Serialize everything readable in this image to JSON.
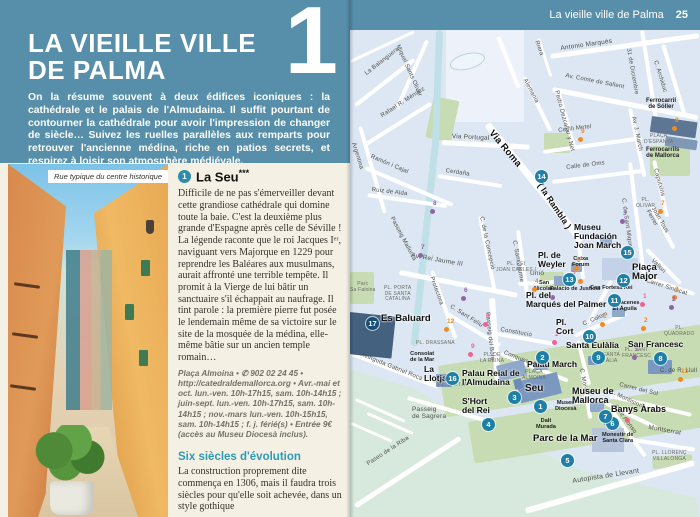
{
  "colors": {
    "header_blue": "#578fab",
    "accent_teal": "#2e9ab8",
    "poi_circle": "#1f7fa6",
    "orange": "#ef8b1f",
    "purple": "#9263a8",
    "pink": "#ee6392"
  },
  "left_page": {
    "chapter_number": "1",
    "title_line1": "LA VIEILLE VILLE",
    "title_line2": "DE PALMA",
    "intro": "On la résume souvent à deux édifices iconiques : la cathédrale et le palais de l'Almudaina. Il suffit pourtant de contourner la cathédrale pour avoir l'impression de changer de siècle… Suivez les ruelles parallèles aux remparts pour retrouver l'ancienne médina, riche en patios secrets, et respirez à loisir son atmosphère médiévale.",
    "photo_caption": "Rue typique du centre historique",
    "section1": {
      "marker": "1",
      "title": "La Seu",
      "stars": "***",
      "body": "Difficile de ne pas s'émerveiller devant cette grandiose cathédrale qui domine toute la baie. C'est la deuxième plus grande d'Espagne après celle de Séville ! La légende raconte que le roi Jacques Iᵉʳ, naviguant vers Majorque en 1229 pour reprendre les Baléares aux musulmans, aurait affronté une terrible tempête. Il promit à la Vierge de lui bâtir un sanctuaire s'il échappait au naufrage. Il tint parole : la première pierre fut posée le lendemain même de sa victoire sur le site de la mosquée de la médina, elle-même bâtie sur un ancien temple romain…",
      "info": "Plaça Almoina • ✆ 902 02 24 45 • http://catedraldemallorca.org • Avr.-mai et oct. lun.-ven. 10h-17h15, sam. 10h-14h15 ; juin-sept. lun.-ven. 10h-17h15, sam. 10h-14h15 ; nov.-mars lun.-ven. 10h-15h15, sam. 10h-14h15 ; f. j. férié(s) • Entrée 9€ (accès au Museu Diocesà inclus)."
    },
    "section2": {
      "title": "Six siècles d'évolution",
      "body": "La construction proprement dite commença en 1306, mais il faudra trois siècles pour qu'elle soit achevée, dans un style gothique"
    }
  },
  "right_page": {
    "header": "La vieille ville de Palma",
    "page_number": "25",
    "map": {
      "scale_labels": {
        "start": "0",
        "mid": "100",
        "end": "200 m"
      },
      "pois": [
        {
          "n": "1",
          "label": "Seu",
          "cx": 184,
          "cy": 370,
          "lx": 175,
          "ly": 354,
          "fs": 10
        },
        {
          "n": "2",
          "label": "Palau March",
          "cx": 186,
          "cy": 321,
          "lx": 177,
          "ly": 330
        },
        {
          "n": "3",
          "label": "Palau Reial de\nl'Almudaina",
          "cx": 158,
          "cy": 361,
          "lx": 112,
          "ly": 339
        },
        {
          "n": "4",
          "label": "S'Hort\ndel Rei",
          "cx": 132,
          "cy": 388,
          "lx": 112,
          "ly": 367
        },
        {
          "n": "5",
          "label": "Parc de la Mar",
          "cx": 211,
          "cy": 424,
          "lx": 183,
          "ly": 404,
          "fs": 9.5
        },
        {
          "n": "6",
          "label": "Banys Àrabs",
          "cx": 256,
          "cy": 387,
          "lx": 261,
          "ly": 375,
          "fs": 9
        },
        {
          "n": "7",
          "label": "Museu de\nMallorca",
          "cx": 249,
          "cy": 380,
          "lx": 222,
          "ly": 357,
          "fs": 9
        },
        {
          "n": "8",
          "label": "San Francesc",
          "cx": 304,
          "cy": 322,
          "lx": 278,
          "ly": 310,
          "fs": 8.5
        },
        {
          "n": "9",
          "label": "Santa Eulàlia",
          "cx": 242,
          "cy": 321,
          "lx": 216,
          "ly": 311,
          "fs": 8.5
        },
        {
          "n": "10",
          "label": "Pl.\nCort",
          "cx": 233,
          "cy": 300,
          "lx": 206,
          "ly": 288
        },
        {
          "n": "11",
          "label": "Pl. del\nMarqués del Palmer",
          "cx": 258,
          "cy": 264,
          "lx": 176,
          "ly": 261
        },
        {
          "n": "12",
          "label": "Plaça\nMajor",
          "cx": 267,
          "cy": 244,
          "lx": 282,
          "ly": 233,
          "fs": 9.5
        },
        {
          "n": "13",
          "label": "Pl. de\nWeyler",
          "cx": 213,
          "cy": 243,
          "lx": 188,
          "ly": 221
        },
        {
          "n": "14",
          "label": "",
          "cx": 185,
          "cy": 140,
          "lx": 0,
          "ly": 0
        },
        {
          "n": "15",
          "label": "Museu\nFundación\nJoan March",
          "cx": 271,
          "cy": 216,
          "lx": 224,
          "ly": 193
        },
        {
          "n": "16",
          "label": "La\nLlotja",
          "cx": 96,
          "cy": 342,
          "lx": 74,
          "ly": 335
        },
        {
          "n": "17",
          "label": "Es Baluard",
          "cx": 16,
          "cy": 287,
          "lx": 31,
          "ly": 284,
          "fs": 9.5,
          "dark": true
        }
      ],
      "streets": [
        {
          "t": "Via Roma",
          "x": 145,
          "y": 98,
          "r": 50,
          "b": 1,
          "s": 9.5
        },
        {
          "t": "( la  Rambla )",
          "x": 194,
          "y": 151,
          "r": 56,
          "b": 1,
          "s": 8.5
        },
        {
          "t": "La Balanguera",
          "x": 14,
          "y": 42,
          "r": -38
        },
        {
          "t": "Miquel Sants Oliver",
          "x": 50,
          "y": 14,
          "r": 66
        },
        {
          "t": "Rafael R. Méndez",
          "x": 30,
          "y": 84,
          "r": -33
        },
        {
          "t": "Argentina",
          "x": 6,
          "y": 112,
          "r": 73
        },
        {
          "t": "Ramón i Cajal",
          "x": 22,
          "y": 124,
          "r": 23
        },
        {
          "t": "Ruiz de Alda",
          "x": 22,
          "y": 157,
          "r": 7
        },
        {
          "t": "Via Portugal",
          "x": 102,
          "y": 103,
          "r": 3,
          "s": 6.5
        },
        {
          "t": "Cerdaña",
          "x": 96,
          "y": 138,
          "r": 9
        },
        {
          "t": "Riera",
          "x": 189,
          "y": 10,
          "r": 70
        },
        {
          "t": "Alemania",
          "x": 177,
          "y": 48,
          "r": 62
        },
        {
          "t": "Antonio Marquès",
          "x": 210,
          "y": 15,
          "r": -8,
          "s": 6.5
        },
        {
          "t": "Av. Comte de Sallent",
          "x": 216,
          "y": 43,
          "r": 11
        },
        {
          "t": "31 de Diciembre",
          "x": 281,
          "y": 18,
          "r": 80
        },
        {
          "t": "C. Archiduc",
          "x": 308,
          "y": 30,
          "r": 73
        },
        {
          "t": "Av. J. March",
          "x": 286,
          "y": 86,
          "r": 78
        },
        {
          "t": "Pedro Dezcallar y Net",
          "x": 209,
          "y": 60,
          "r": 75
        },
        {
          "t": "Cecili Metel",
          "x": 208,
          "y": 98,
          "r": -7
        },
        {
          "t": "Calle de Oms",
          "x": 216,
          "y": 135,
          "r": -7
        },
        {
          "t": "C. de Sant Miquel",
          "x": 276,
          "y": 168,
          "r": 82
        },
        {
          "t": "Caputxins",
          "x": 308,
          "y": 138,
          "r": 75
        },
        {
          "t": "Joan Tous Ferrer",
          "x": 305,
          "y": 176,
          "r": 60
        },
        {
          "t": "Vallori",
          "x": 304,
          "y": 228,
          "r": 45
        },
        {
          "t": "Carrer Sindicat",
          "x": 297,
          "y": 248,
          "r": 18
        },
        {
          "t": "Unió",
          "x": 180,
          "y": 240,
          "r": 0,
          "s": 6.5
        },
        {
          "t": "Av. Rei Jaume III",
          "x": 62,
          "y": 222,
          "r": 10,
          "s": 6.5
        },
        {
          "t": "C. de la Concepció",
          "x": 134,
          "y": 186,
          "r": 78
        },
        {
          "t": "C. Sant Jaume",
          "x": 167,
          "y": 210,
          "r": 80
        },
        {
          "t": "Protectora",
          "x": 84,
          "y": 246,
          "r": 70
        },
        {
          "t": "C. Sant Feliu",
          "x": 102,
          "y": 274,
          "r": 32
        },
        {
          "t": "Passeig del Born",
          "x": 140,
          "y": 282,
          "r": 84
        },
        {
          "t": "Constitució",
          "x": 151,
          "y": 297,
          "r": 10
        },
        {
          "t": "Conquistador",
          "x": 155,
          "y": 320,
          "r": 22
        },
        {
          "t": "C. Colom",
          "x": 232,
          "y": 292,
          "r": -24
        },
        {
          "t": "C. Morey",
          "x": 234,
          "y": 338,
          "r": 80
        },
        {
          "t": "Carrer del Sol",
          "x": 270,
          "y": 352,
          "r": 14
        },
        {
          "t": "C. Montision",
          "x": 261,
          "y": 359,
          "r": 25
        },
        {
          "t": "Sant Alonso",
          "x": 267,
          "y": 374,
          "r": 53
        },
        {
          "t": "Montserrat",
          "x": 299,
          "y": 394,
          "r": 10,
          "s": 6.5
        },
        {
          "t": "Passeig Mallorca",
          "x": 44,
          "y": 186,
          "r": 62
        },
        {
          "t": "Avinguda Gabriel Roca",
          "x": 12,
          "y": 322,
          "r": 22
        },
        {
          "t": "Passeig\nde Sagrera",
          "x": 62,
          "y": 376,
          "r": 0,
          "s": 6.5
        },
        {
          "t": "Paseo de la Riba",
          "x": 16,
          "y": 432,
          "r": -33
        },
        {
          "t": "Autopista de Llevant",
          "x": 222,
          "y": 448,
          "r": -9,
          "s": 7
        },
        {
          "t": "C. de R. Llull",
          "x": 310,
          "y": 338,
          "r": 0
        }
      ],
      "places": [
        {
          "t": "PLAÇA\nALMOINA",
          "x": 172,
          "y": 340
        },
        {
          "t": "PL. LLOTJA",
          "x": 88,
          "y": 353
        },
        {
          "t": "PL. DE\nLA REINA",
          "x": 130,
          "y": 323
        },
        {
          "t": "PL. REI\nJOAN CARLES I",
          "x": 146,
          "y": 232
        },
        {
          "t": "PL. PORTA\nDE SANTA\nCATALINA",
          "x": 34,
          "y": 256
        },
        {
          "t": "PL. DRASSANA",
          "x": 66,
          "y": 311
        },
        {
          "t": "PLAÇA\nD'ESPANYA",
          "x": 294,
          "y": 104
        },
        {
          "t": "PL.\nOLIVAR",
          "x": 286,
          "y": 168
        },
        {
          "t": "PL.\nQUADRADO",
          "x": 314,
          "y": 296
        },
        {
          "t": "PL. SANT\nFRANCESC",
          "x": 272,
          "y": 318
        },
        {
          "t": "PL. SANTA\nEULÀLIA",
          "x": 243,
          "y": 323
        },
        {
          "t": "PL. LLORENÇ\nVILLALONGA",
          "x": 302,
          "y": 421
        },
        {
          "t": "Parc\nSa Faixina",
          "x": 0,
          "y": 252
        },
        {
          "t": "Consolat\nde la Mar",
          "x": 60,
          "y": 321,
          "k": "b"
        },
        {
          "t": "Museu\nDiocesà",
          "x": 205,
          "y": 370,
          "k": "b"
        },
        {
          "t": "Dalt\nMurada",
          "x": 186,
          "y": 388,
          "k": "b"
        },
        {
          "t": "Monestir de\nSanta Clara",
          "x": 252,
          "y": 402,
          "k": "b"
        },
        {
          "t": "Caixa\nForum",
          "x": 222,
          "y": 226,
          "k": "b"
        },
        {
          "t": "Palacio de Justicia",
          "x": 200,
          "y": 256,
          "k": "b"
        },
        {
          "t": "San\nNicolau",
          "x": 184,
          "y": 250,
          "k": "b"
        },
        {
          "t": "Can Fortesa Rei",
          "x": 240,
          "y": 255,
          "k": "b"
        },
        {
          "t": "Almacenes\nEl Águila",
          "x": 260,
          "y": 270,
          "k": "b"
        },
        {
          "t": "Ferrocarril\nde Sóller",
          "x": 296,
          "y": 68,
          "k": "b",
          "fs": 6
        },
        {
          "t": "Ferrocarrils\nde Mallorca",
          "x": 296,
          "y": 117,
          "k": "b",
          "fs": 6
        }
      ],
      "dots": [
        {
          "c": "o",
          "n": "9",
          "x": 228,
          "y": 107
        },
        {
          "c": "o",
          "n": "8",
          "x": 322,
          "y": 96
        },
        {
          "c": "o",
          "n": "7",
          "x": 308,
          "y": 179
        },
        {
          "c": "p",
          "n": "3",
          "x": 270,
          "y": 189
        },
        {
          "c": "o",
          "n": "6",
          "x": 224,
          "y": 236
        },
        {
          "c": "k",
          "n": "5",
          "x": 219,
          "y": 248
        },
        {
          "c": "o",
          "n": "",
          "x": 228,
          "y": 249
        },
        {
          "c": "o",
          "n": "4",
          "x": 182,
          "y": 257
        },
        {
          "c": "p",
          "n": "",
          "x": 200,
          "y": 265
        },
        {
          "c": "o",
          "n": "1",
          "x": 250,
          "y": 292
        },
        {
          "c": "o",
          "n": "2",
          "x": 291,
          "y": 296
        },
        {
          "c": "o",
          "n": "3",
          "x": 322,
          "y": 265
        },
        {
          "c": "p",
          "n": "2",
          "x": 319,
          "y": 275
        },
        {
          "c": "k",
          "n": "1",
          "x": 290,
          "y": 272
        },
        {
          "c": "k",
          "n": "2",
          "x": 202,
          "y": 310
        },
        {
          "c": "p",
          "n": "1",
          "x": 282,
          "y": 325
        },
        {
          "c": "o",
          "n": "13",
          "x": 328,
          "y": 347
        },
        {
          "c": "k",
          "n": "1",
          "x": 275,
          "y": 388
        },
        {
          "c": "p",
          "n": "8",
          "x": 80,
          "y": 179
        },
        {
          "c": "p",
          "n": "7",
          "x": 68,
          "y": 223
        },
        {
          "c": "p",
          "n": "6",
          "x": 111,
          "y": 266
        },
        {
          "c": "k",
          "n": "6",
          "x": 133,
          "y": 292
        },
        {
          "c": "k",
          "n": "9",
          "x": 118,
          "y": 322
        },
        {
          "c": "o",
          "n": "12",
          "x": 94,
          "y": 297
        }
      ]
    }
  }
}
